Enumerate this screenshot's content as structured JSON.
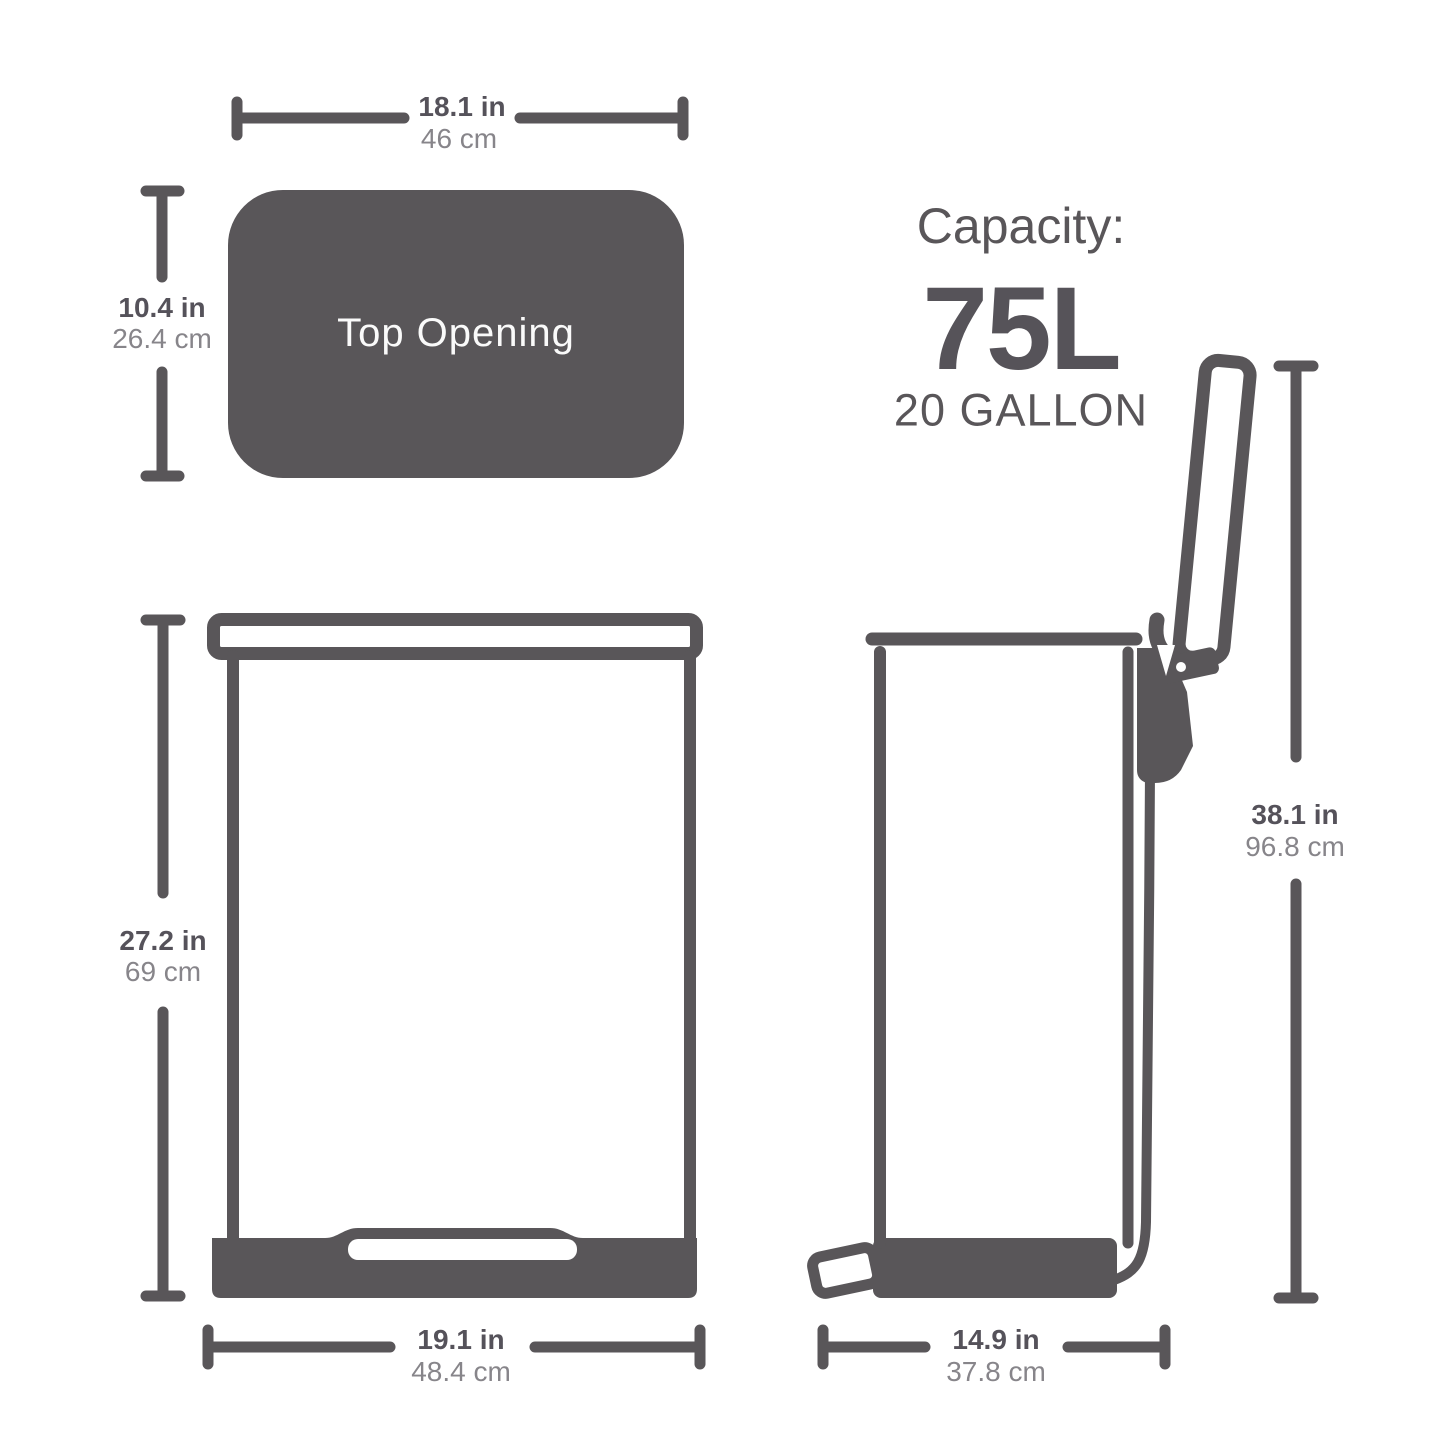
{
  "colors": {
    "shape_dark": "#595659",
    "text_dark": "#55525a",
    "text_light": "#87858a",
    "background": "#ffffff"
  },
  "top_view": {
    "label": "Top Opening",
    "width": {
      "in_value": "18.1 in",
      "cm_value": "46 cm"
    },
    "depth": {
      "in_value": "10.4 in",
      "cm_value": "26.4 cm"
    }
  },
  "capacity": {
    "title": "Capacity:",
    "liters": "75L",
    "gallons": "20 GALLON"
  },
  "front_view": {
    "height": {
      "in_value": "27.2 in",
      "cm_value": "69 cm"
    },
    "width": {
      "in_value": "19.1 in",
      "cm_value": "48.4 cm"
    }
  },
  "side_view": {
    "total_height": {
      "in_value": "38.1 in",
      "cm_value": "96.8 cm"
    },
    "depth": {
      "in_value": "14.9 in",
      "cm_value": "37.8 cm"
    }
  }
}
